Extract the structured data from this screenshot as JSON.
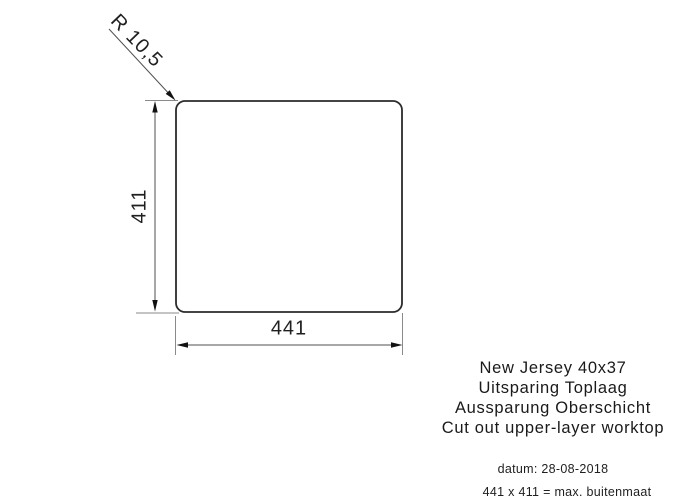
{
  "drawing": {
    "product": "New Jersey 40x37",
    "description_nl": "Uitsparing Toplaag",
    "description_de": "Aussparung Oberschicht",
    "description_en": "Cut out upper-layer worktop",
    "dimensions": {
      "width": "441",
      "height": "411",
      "corner_radius": "R 10,5"
    },
    "footer": {
      "date": "datum: 28-08-2018",
      "outer_size_note": "441 x 411 = max. buitenmaat"
    },
    "colors": {
      "outline": "#2b2b2b",
      "dimension_line": "#4f4f4f",
      "witness_line": "#8a8a8a",
      "text": "#1a1a1a",
      "background": "#ffffff"
    }
  }
}
